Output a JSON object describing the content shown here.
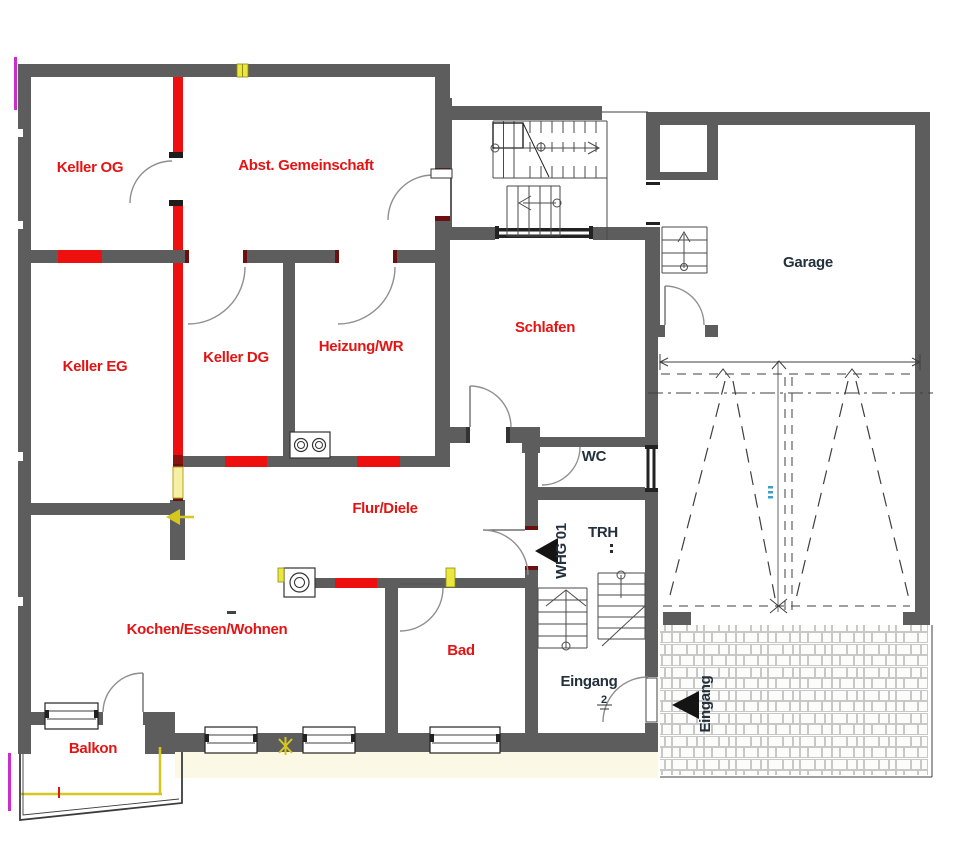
{
  "plan": {
    "rooms": {
      "keller_og": {
        "label": "Keller OG"
      },
      "abst_gemeinschaft": {
        "label": "Abst. Gemeinschaft"
      },
      "keller_eg": {
        "label": "Keller EG"
      },
      "keller_dg": {
        "label": "Keller DG"
      },
      "heizung_wr": {
        "label": "Heizung/WR"
      },
      "schlafen": {
        "label": "Schlafen"
      },
      "garage": {
        "label": "Garage"
      },
      "wc": {
        "label": "WC"
      },
      "trh": {
        "label": "TRH"
      },
      "flur_diele": {
        "label": "Flur/Diele"
      },
      "kochen_essen_wohnen": {
        "label": "Kochen/Essen/Wohnen"
      },
      "bad": {
        "label": "Bad"
      },
      "eingang": {
        "label": "Eingang"
      },
      "balkon": {
        "label": "Balkon"
      }
    },
    "markers": {
      "apartment_entry": {
        "label": "WHG 01"
      },
      "outdoor_entry": {
        "label": "Eingang"
      },
      "entry_step_count": "2"
    },
    "colors": {
      "wall": "#5d5d5d",
      "red_wall": "#ee0f0f",
      "label_red": "#e31414",
      "label_dark": "#23313d",
      "accent_yellow": "#e3d82e",
      "accent_magenta": "#cb2ccb",
      "accent_blue": "#3f9fca"
    }
  }
}
